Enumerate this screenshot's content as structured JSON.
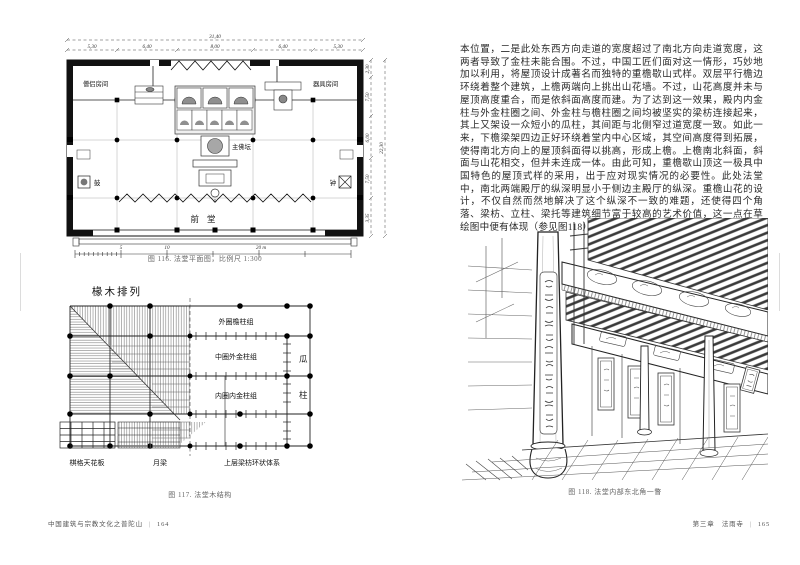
{
  "page": {
    "left_footer": {
      "book_title": "中国建筑与宗教文化之普陀山",
      "divider": "|",
      "page_number": "164"
    },
    "right_footer": {
      "chapter_title": "第三章　法雨寺",
      "divider": "|",
      "page_number": "165"
    }
  },
  "article": {
    "body_text": "本位置，二是此处东西方向走道的宽度超过了南北方向走道宽度，这两者导致了金柱未能合围。不过，中国工匠们面对这一情形，巧妙地加以利用，将屋顶设计成著名而独特的重檐歇山式样。双层平行檐边环绕着整个建筑，上檐两端向上挑出山花墙。不过，山花高度并未与屋顶高度重合，而是依斜面高度而建。为了达到这一效果，殿内内金柱与外金柱圈之间、外金柱与檐柱圈之间均被坚实的梁枋连接起来，其上又架设一众短小的瓜柱，其间距与北侧窄过道宽度一致。如此一来，下檐梁架四边正好环绕着堂内中心区域，其空间高度得到拓展，使得南北方向上的屋顶斜面得以挑高，形成上檐。上檐南北斜面，斜面与山花相交，但并未连成一体。由此可知，重檐歇山顶这一极具中国特色的屋顶式样的采用，出于应对现实情况的必要性。此处法堂中，南北两端殿厅的纵深明显小于侧边主殿厅的纵深。重檐山花的设计，不仅自然而然地解决了这个纵深不一致的难题，还使得四个角落、梁枋、立柱、梁托等建筑细节富于较高的艺术价值，这一点在草绘图中便有体现（参见图118）。"
  },
  "figure116": {
    "caption": "图 116. 法堂平面图，比例尺 1:300",
    "dims": {
      "total_width": "31,40",
      "top_segments": [
        "5,30",
        "6,40",
        "8,00",
        "6,40",
        "5,30"
      ],
      "total_height": "22,30",
      "right_segments": [
        "2,30",
        "7,50",
        "6,00",
        "7,50",
        "3,35"
      ]
    },
    "scale_bar": {
      "labels": [
        "5",
        "10",
        "20 m"
      ]
    },
    "labels": {
      "room_left": "僧侣房间",
      "room_right": "器具房间",
      "main_altar": "主佛坛",
      "drum": "鼓",
      "bell": "钟",
      "front_hall": "前堂"
    }
  },
  "figure117": {
    "title": "椽木排列",
    "caption": "图 117. 法堂木结构",
    "labels": {
      "outer_ring": "外圈檐柱组",
      "middle_ring": "中圈外金柱组",
      "inner_ring": "内圈内金柱组",
      "melon": "瓜",
      "post": "柱",
      "coffered_ceiling": "棋格天花板",
      "moon_beam": "月梁",
      "upper_beam_ring": "上层梁枋环状体系"
    }
  },
  "figure118": {
    "caption": "图 118. 法堂内部东北角一瞥"
  }
}
